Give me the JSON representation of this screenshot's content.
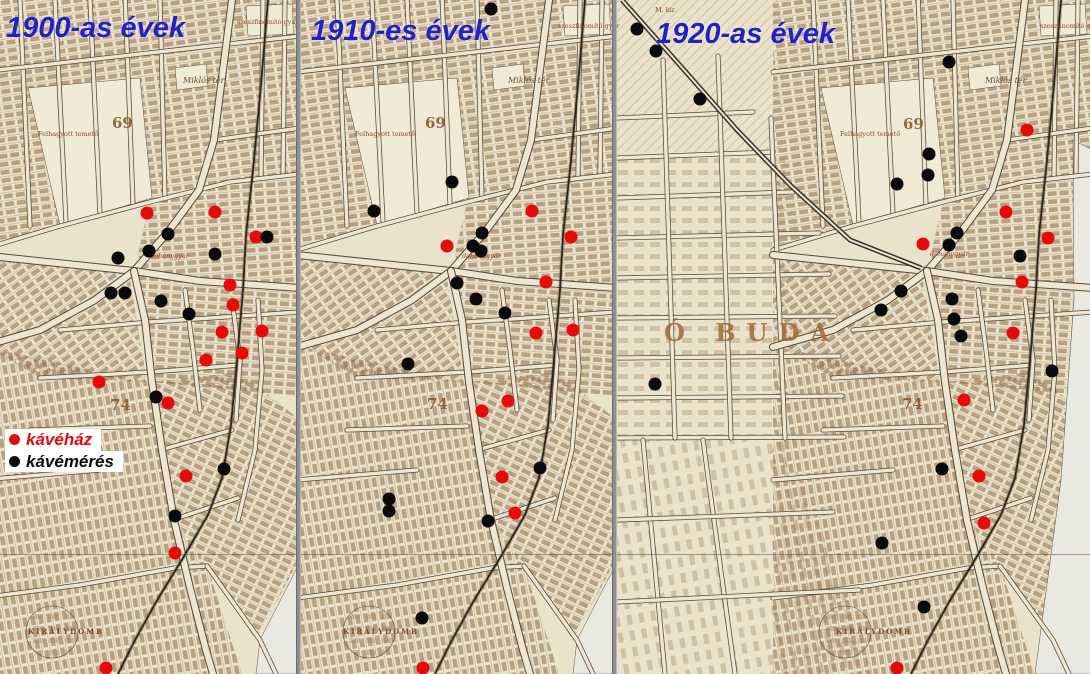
{
  "panels": [
    {
      "title": "1900-as évek",
      "kavehaz": [
        [
          147,
          213
        ],
        [
          215,
          212
        ],
        [
          256,
          237
        ],
        [
          230,
          285
        ],
        [
          233,
          305
        ],
        [
          222,
          332
        ],
        [
          262,
          331
        ],
        [
          242,
          353
        ],
        [
          206,
          360
        ],
        [
          99,
          382
        ],
        [
          168,
          403
        ],
        [
          186,
          476
        ],
        [
          175,
          553
        ],
        [
          106,
          668
        ]
      ],
      "kavemeres": [
        [
          168,
          234
        ],
        [
          267,
          237
        ],
        [
          149,
          251
        ],
        [
          118,
          258
        ],
        [
          215,
          254
        ],
        [
          111,
          293
        ],
        [
          125,
          293
        ],
        [
          161,
          301
        ],
        [
          189,
          314
        ],
        [
          156,
          397
        ],
        [
          224,
          469
        ],
        [
          175,
          516
        ]
      ]
    },
    {
      "title": "1910-es évek",
      "kavehaz": [
        [
          532,
          211
        ],
        [
          571,
          237
        ],
        [
          447,
          246
        ],
        [
          546,
          282
        ],
        [
          536,
          333
        ],
        [
          573,
          330
        ],
        [
          508,
          401
        ],
        [
          482,
          411
        ],
        [
          502,
          477
        ],
        [
          515,
          513
        ],
        [
          423,
          668
        ]
      ],
      "kavemeres": [
        [
          491,
          9
        ],
        [
          452,
          182
        ],
        [
          374,
          211
        ],
        [
          482,
          233
        ],
        [
          473,
          246
        ],
        [
          481,
          251
        ],
        [
          457,
          283
        ],
        [
          476,
          299
        ],
        [
          505,
          313
        ],
        [
          408,
          364
        ],
        [
          540,
          468
        ],
        [
          389,
          499
        ],
        [
          389,
          511
        ],
        [
          488,
          521
        ],
        [
          422,
          618
        ]
      ]
    },
    {
      "title": "1920-as évek",
      "kavehaz": [
        [
          1027,
          130
        ],
        [
          1006,
          212
        ],
        [
          923,
          244
        ],
        [
          1048,
          238
        ],
        [
          1022,
          282
        ],
        [
          1013,
          333
        ],
        [
          964,
          400
        ],
        [
          979,
          476
        ],
        [
          984,
          523
        ],
        [
          897,
          668
        ]
      ],
      "kavemeres": [
        [
          637,
          29
        ],
        [
          656,
          51
        ],
        [
          700,
          99
        ],
        [
          949,
          62
        ],
        [
          929,
          154
        ],
        [
          928,
          175
        ],
        [
          897,
          184
        ],
        [
          957,
          233
        ],
        [
          949,
          245
        ],
        [
          1020,
          256
        ],
        [
          901,
          291
        ],
        [
          881,
          310
        ],
        [
          952,
          299
        ],
        [
          954,
          319
        ],
        [
          961,
          336
        ],
        [
          1052,
          371
        ],
        [
          655,
          384
        ],
        [
          942,
          469
        ],
        [
          882,
          543
        ],
        [
          924,
          607
        ]
      ]
    }
  ],
  "legend": {
    "items": [
      {
        "label": "kávéház",
        "color": "#e60a0a"
      },
      {
        "label": "kávémérés",
        "color": "#0a0a0a"
      }
    ]
  },
  "map_labels": [
    {
      "text": "Miklós tér",
      "x": 183,
      "y": 76,
      "cls": "lbl-place"
    },
    {
      "text": "Miklós tér",
      "x": 508,
      "y": 76,
      "cls": "lbl-place"
    },
    {
      "text": "Miklós tér",
      "x": 985,
      "y": 76,
      "cls": "lbl-place"
    },
    {
      "text": "69",
      "x": 112,
      "y": 114,
      "cls": "lbl-block"
    },
    {
      "text": "69",
      "x": 425,
      "y": 114,
      "cls": "lbl-block"
    },
    {
      "text": "69",
      "x": 903,
      "y": 115,
      "cls": "lbl-block"
    },
    {
      "text": "74",
      "x": 110,
      "y": 396,
      "cls": "lbl-block"
    },
    {
      "text": "74",
      "x": 427,
      "y": 395,
      "cls": "lbl-block"
    },
    {
      "text": "74",
      "x": 902,
      "y": 395,
      "cls": "lbl-block"
    },
    {
      "text": "Ó BUDA",
      "x": 664,
      "y": 318,
      "cls": "lbl-obuda"
    },
    {
      "text": "Felhagyott temető",
      "x": 38,
      "y": 130,
      "cls": "lbl-small"
    },
    {
      "text": "Felhagyott temető",
      "x": 355,
      "y": 130,
      "cls": "lbl-small"
    },
    {
      "text": "Felhagyott temető",
      "x": 840,
      "y": 130,
      "cls": "lbl-small"
    },
    {
      "text": "szeszfinomító gyár",
      "x": 237,
      "y": 18,
      "cls": "lbl-small"
    },
    {
      "text": "szeszfinomító gyár",
      "x": 558,
      "y": 22,
      "cls": "lbl-small"
    },
    {
      "text": "szeszfinomító gyár",
      "x": 1040,
      "y": 22,
      "cls": "lbl-small"
    },
    {
      "text": "dohánygyár",
      "x": 150,
      "y": 252,
      "cls": "lbl-factory"
    },
    {
      "text": "dohánygyár",
      "x": 462,
      "y": 252,
      "cls": "lbl-factory"
    },
    {
      "text": "dohánygyár",
      "x": 930,
      "y": 250,
      "cls": "lbl-factory"
    },
    {
      "text": "KIRÁLYDOMB",
      "x": 28,
      "y": 627,
      "cls": "lbl-caps"
    },
    {
      "text": "KIRÁLYDOMB",
      "x": 343,
      "y": 627,
      "cls": "lbl-caps"
    },
    {
      "text": "KIRÁLYDOMB",
      "x": 836,
      "y": 627,
      "cls": "lbl-caps"
    },
    {
      "text": "M. kir.",
      "x": 655,
      "y": 6,
      "cls": "lbl-small"
    }
  ],
  "colors": {
    "kavehaz_dot": "#e60a0a",
    "kavemeres_dot": "#0a0a0a",
    "title": "#2222c4",
    "divider": "#8f8f8f",
    "map_base": "#ebe2cb"
  }
}
